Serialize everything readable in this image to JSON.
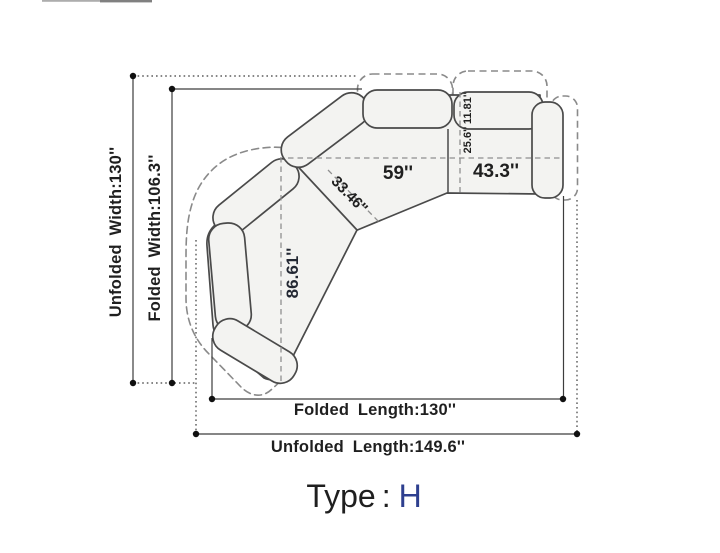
{
  "diagram": {
    "type_prefix": "Type",
    "type_separator": ":",
    "type_value": "H",
    "labels": {
      "unfolded_width": "Unfolded Width:130''",
      "folded_width": "Folded Width:106.3''",
      "folded_length": "Folded Length:130''",
      "unfolded_length": "Unfolded Length:149.6''",
      "center_seat_width": "59''",
      "right_seat_width": "43.3''",
      "corner_diagonal": "33.46''",
      "chaise_length": "86.61''",
      "seat_depth": "25.6''",
      "backrest_depth": "11.81''"
    },
    "colors": {
      "piece_fill": "#f3f3f1",
      "piece_outline": "#4a4a4a",
      "dashed_outline": "#8a8a8a",
      "dimension_line": "#3d3d3d",
      "label_text": "#1f1f1f",
      "type_value_text": "#2e3f8f"
    }
  }
}
